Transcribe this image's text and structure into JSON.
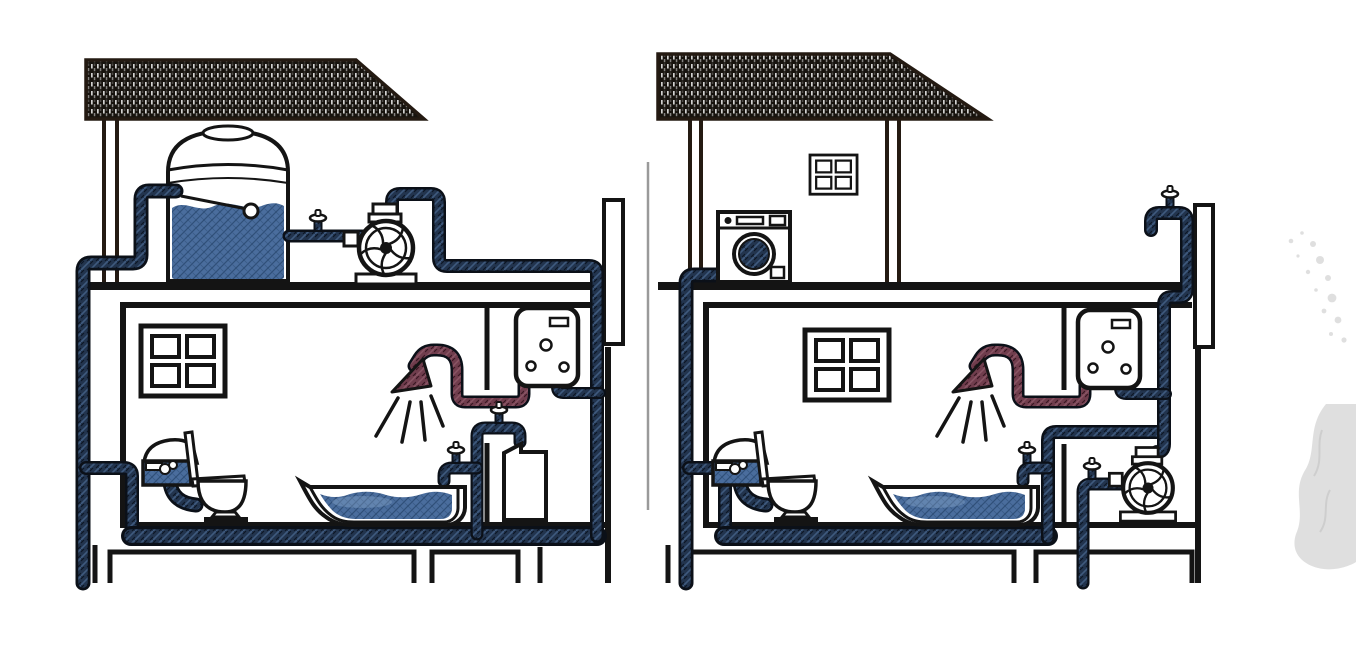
{
  "diagram": {
    "type": "technical-illustration",
    "description": "Cross-section comparison of two houses' domestic water supply systems. Left house: rooftop storage tank with float valve feeding fixtures by gravity, with a centrifugal booster pump on the attic floor. Right house: direct supply with an inline centrifugal pressure pump and isolation valve at ground level, washing machine and window in the attic, and a rooftop tap. Cold water pipes are dark blue, the hot water line from the wall heater to the shower is dark red. A faint water-splash watermark sits at the right edge.",
    "panels": [
      {
        "id": "left-house",
        "system": "overhead-tank-supply",
        "components": [
          "hatched roof",
          "storage tank with float valve",
          "gate valve",
          "centrifugal booster pump",
          "four-pane window",
          "toilet with cistern",
          "shower with hot water arc",
          "bathtub with water",
          "wall-mounted water heater",
          "wash basin with tap",
          "cold riser and floor distribution pipes",
          "vent standpipe"
        ]
      },
      {
        "id": "right-house",
        "system": "direct-pump-supply",
        "components": [
          "hatched roof",
          "attic window",
          "washing machine",
          "rooftop tap",
          "four-pane window",
          "toilet with cistern",
          "shower with hot water arc",
          "bathtub with water",
          "wall-mounted water heater",
          "inline centrifugal pump with isolation valve",
          "cold riser and floor distribution pipes",
          "vent standpipe"
        ]
      }
    ],
    "divider": "thin gray vertical line between panels",
    "watermark": "water-splash"
  },
  "colors": {
    "bg": "#ffffff",
    "outline": "#141414",
    "structure": "#241a12",
    "pipe_cold": "#22344e",
    "pipe_cold_hi": "#48678e",
    "pipe_line": "#0b1018",
    "pipe_hot": "#703d4d",
    "pipe_hot_hi": "#95606f",
    "water": "#4a6d9d",
    "water_line": "#27476f",
    "roof_dark": "#17130e",
    "roof_light": "#f2f2f2",
    "divider": "#9a9a9a",
    "splash": "#cfcfcf"
  }
}
